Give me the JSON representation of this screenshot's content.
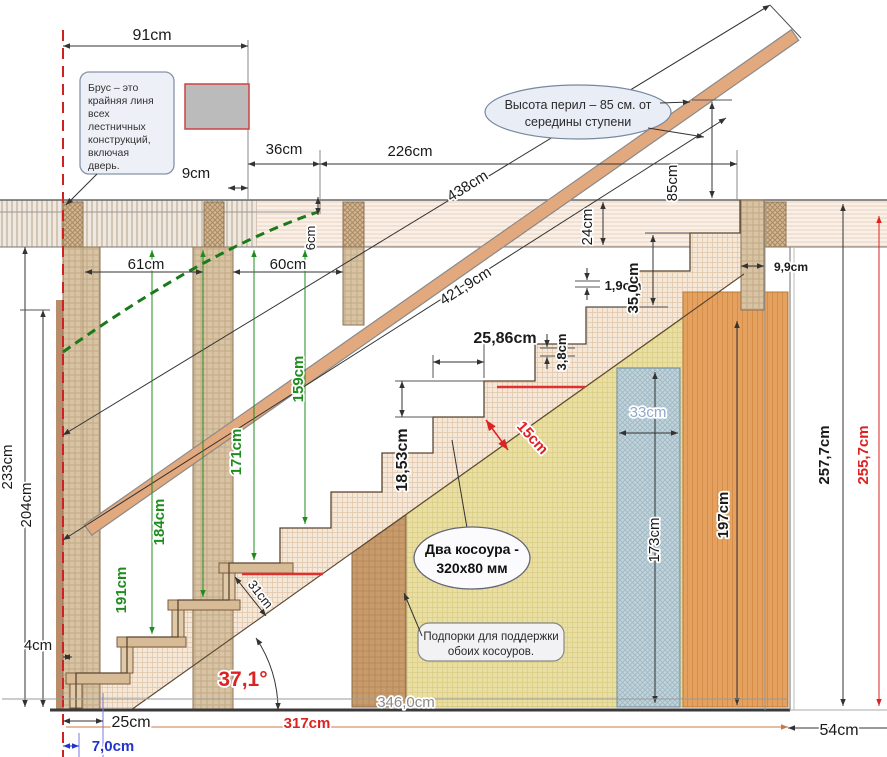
{
  "title": "Чертёж деревянной лестницы с размерами",
  "dims": {
    "d91": "91cm",
    "d9": "9cm",
    "d36": "36cm",
    "d226": "226cm",
    "d438": "438cm",
    "d6": "6cm",
    "d61": "61cm",
    "d60": "60cm",
    "d4219": "421,9cm",
    "d85": "85cm",
    "d24": "24cm",
    "d99": "9,9cm",
    "d19": "1,9cm",
    "d350": "35,0cm",
    "d2586": "25,86cm",
    "d38": "3,8cm",
    "d33": "33cm",
    "d1853": "18,53cm",
    "d15": "15cm",
    "d191": "191cm",
    "d184": "184cm",
    "d171": "171cm",
    "d159": "159cm",
    "d233": "233cm",
    "d204": "204cm",
    "d173": "173cm",
    "d197": "197cm",
    "d2577": "257,7cm",
    "d2557": "255,7cm",
    "angle": "37,1°",
    "d31": "31cm",
    "d4": "4cm",
    "d25": "25cm",
    "d70": "7,0cm",
    "d317": "317cm",
    "d346": "346,0cm",
    "d54": "54cm"
  },
  "callouts": {
    "brus": {
      "line1": "Брус – это",
      "line2": "крайняя линя",
      "line3": "всех",
      "line4": "лестничных",
      "line5": "конструкций,",
      "line6": "включая",
      "line7": "дверь."
    },
    "railing": {
      "line1": "Высота перил – 85 см. от",
      "line2": "середины ступени"
    },
    "stringers": {
      "line1": "Два косоура -",
      "line2": "320х80 мм"
    },
    "props": {
      "line1": "Подпорки для поддержки",
      "line2": "обоих косоуров."
    }
  },
  "colors": {
    "dim_green": "#1e8c1e",
    "dim_red": "#dd2222",
    "dim_blue": "#2233cc",
    "dim_orange": "#c8784a",
    "wood_rail": "#e2a87e",
    "orange_column": "#e5a160",
    "yellow_panel": "#eadfa2",
    "blue_panel": "#c2d4db",
    "red_edge_line": "#cc2222"
  }
}
